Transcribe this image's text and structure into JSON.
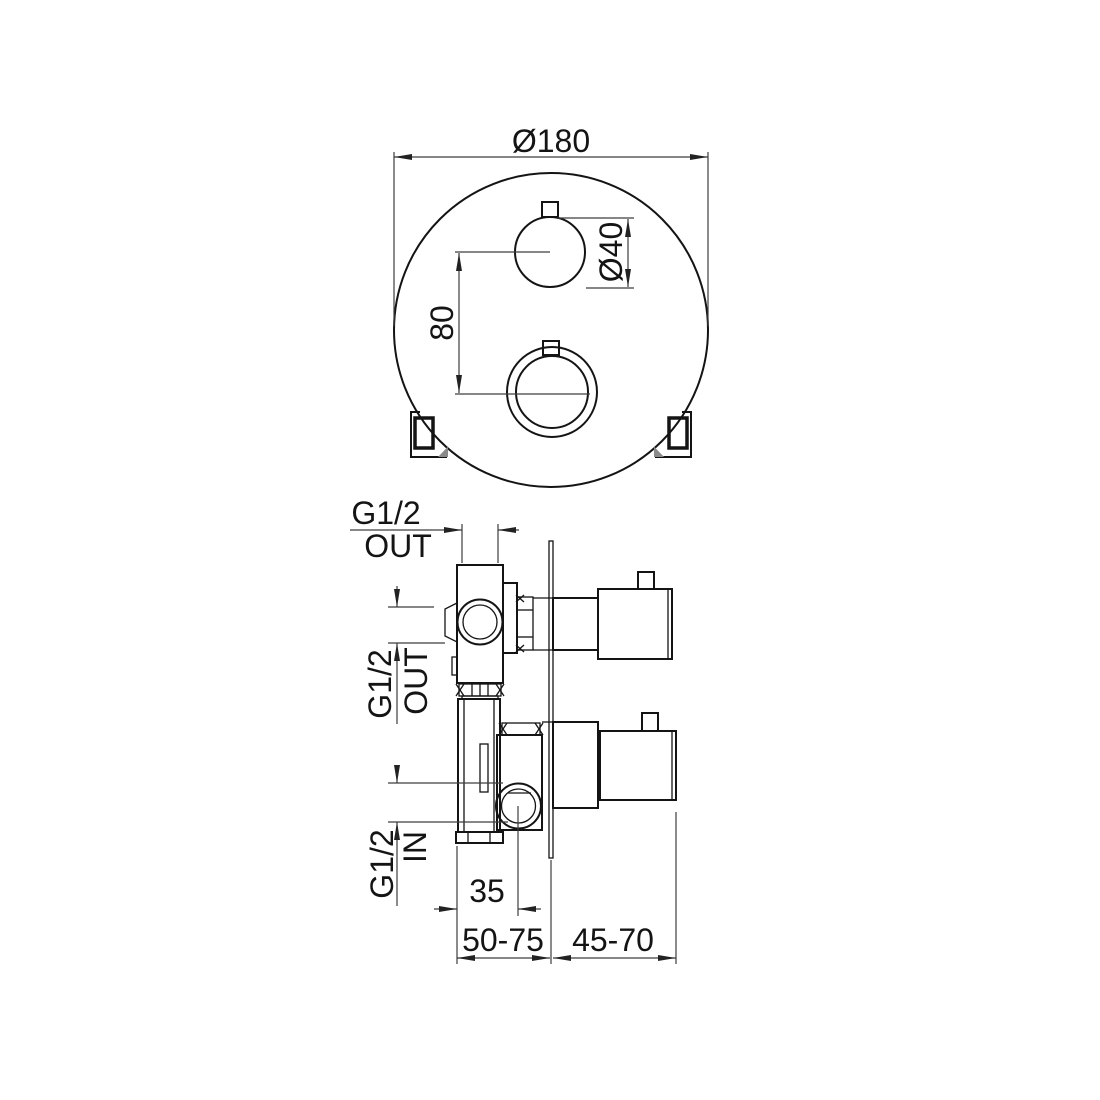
{
  "colors": {
    "background": "#ffffff",
    "line": "#141414",
    "dim": "#3d3d3d"
  },
  "front_view": {
    "plate_diameter": "Ø180",
    "knob_diameter": "Ø40",
    "knob_center_distance": "80"
  },
  "side_view": {
    "top_outlet": {
      "thread": "G1/2",
      "flow": "OUT"
    },
    "side_outlet": {
      "thread": "G1/2",
      "flow": "OUT"
    },
    "inlet": {
      "thread": "G1/2",
      "flow": "IN"
    },
    "inlet_offset": "35",
    "rough_in_depth": "50-75",
    "handle_projection": "45-70"
  }
}
